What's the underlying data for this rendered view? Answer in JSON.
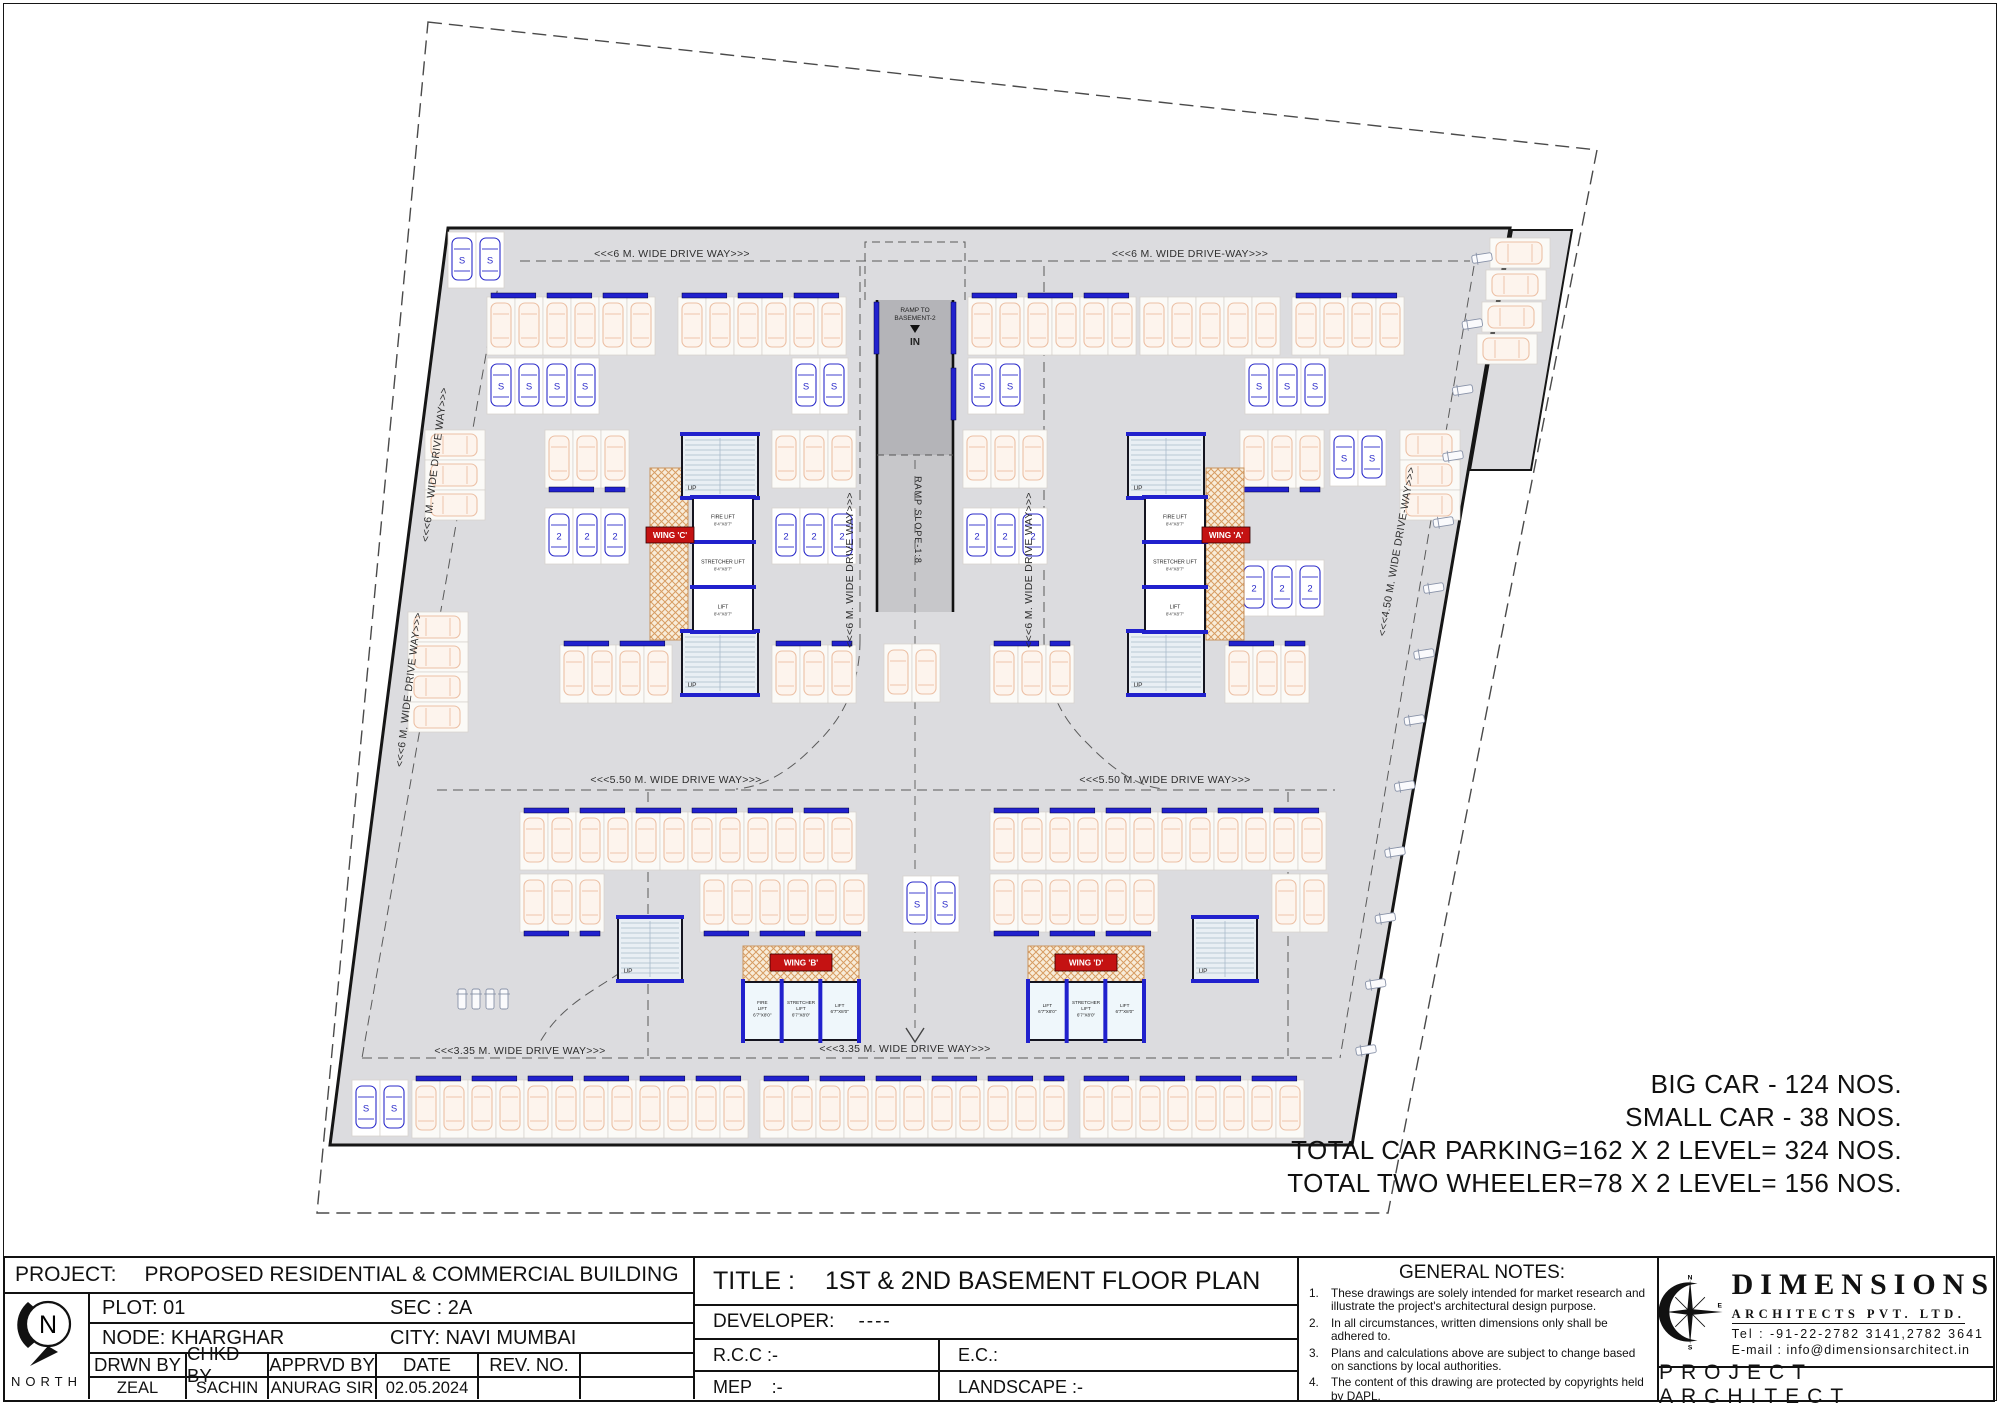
{
  "colors": {
    "blue": "#2121cd",
    "red": "#c41212",
    "hatch": "#d79c63",
    "plan_gray": "#dcdcdf",
    "big_car": "#ecc0a5",
    "small_car": "#2b2bca"
  },
  "stats": {
    "lines": [
      "BIG CAR - 124 NOS.",
      "SMALL CAR - 38 NOS.",
      "TOTAL CAR PARKING=162 X 2 LEVEL= 324 NOS.",
      "TOTAL TWO WHEELER=78 X 2 LEVEL= 156 NOS."
    ]
  },
  "titleblock": {
    "project_label": "PROJECT:",
    "project_value": "PROPOSED RESIDENTIAL & COMMERCIAL BUILDING",
    "plot": "PLOT: 01",
    "sec": "SEC : 2A",
    "node": "NODE: KHARGHAR",
    "city": "CITY: NAVI MUMBAI",
    "col_headers": [
      "DRWN BY",
      "CHKD BY",
      "APPRVD BY",
      "DATE",
      "REV. NO."
    ],
    "col_values": [
      "ZEAL",
      "SACHIN",
      "ANURAG SIR",
      "02.05.2024",
      ""
    ],
    "north_label": "NORTH",
    "north_letter": "N",
    "title_label": "TITLE :",
    "title_value": "1ST & 2ND BASEMENT FLOOR PLAN",
    "developer_label": "DEVELOPER:",
    "developer_value": "----",
    "rcc": "R.C.C :-",
    "ec": "E.C.:",
    "mep": "MEP    :-",
    "landscape": "LANDSCAPE :-"
  },
  "notes": {
    "heading": "GENERAL NOTES:",
    "items": [
      {
        "n": "1.",
        "text": "These drawings are solely intended for market research and illustrate the project's architectural design purpose."
      },
      {
        "n": "2.",
        "text": "In all circumstances, written dimensions only shall be adhered to."
      },
      {
        "n": "3.",
        "text": "Plans and calculations above are subject to change based on sanctions by local authorities."
      },
      {
        "n": "4.",
        "text": "The content of this drawing are protected by copyrights held by DAPL."
      }
    ]
  },
  "firm": {
    "name": "DIMENSIONS",
    "subtitle": "ARCHITECTS PVT. LTD.",
    "tel": "Tel : -91-22-2782 3141,2782 3641",
    "email": "E-mail : info@dimensionsarchitect.in",
    "role": "PROJECT ARCHITECT",
    "compass": {
      "n": "N",
      "e": "E",
      "s": "S"
    }
  },
  "plan": {
    "plot_boundary": [
      [
        428,
        22
      ],
      [
        1597,
        150
      ],
      [
        1388,
        1213
      ],
      [
        317,
        1213
      ]
    ],
    "building_outline": [
      [
        448,
        228
      ],
      [
        1510,
        228
      ],
      [
        1352,
        1145
      ],
      [
        330,
        1145
      ]
    ],
    "annex": [
      [
        1512,
        230
      ],
      [
        1572,
        230
      ],
      [
        1531,
        470
      ],
      [
        1470,
        470
      ]
    ],
    "aisle_paths": [
      "M520,261 H1470",
      "M500,275 L362,1058",
      "M362,1058 H1335",
      "M437,790 H1335",
      "M1474,266 L1340,1058",
      "M860,266 V640",
      "M1044,266 V640",
      "M860,640 Q860,702 816,744 Q776,786 736,789",
      "M1044,640 Q1044,702 1088,744 Q1128,786 1164,789",
      "M648,792 V1056",
      "M1288,792 V1056",
      "M645,952 C612,986 568,994 540,1042"
    ],
    "ramp": {
      "x": 877,
      "y": 300,
      "w": 76,
      "split": 455,
      "end": 612,
      "label1": "RAMP TO",
      "label2": "BASEMENT-2",
      "in_label": "IN",
      "slope": "RAMP SLOPE-1:8"
    },
    "driveways": [
      {
        "t": "<<<6 M. WIDE DRIVE WAY>>>",
        "x": 672,
        "y": 257,
        "r": 0
      },
      {
        "t": "<<<6 M. WIDE DRIVE-WAY>>>",
        "x": 1190,
        "y": 257,
        "r": 0
      },
      {
        "t": "<<<6 M. WIDE DRIVE WAY>>>",
        "x": 438,
        "y": 465,
        "r": -83
      },
      {
        "t": "<<<6 M. WIDE DRIVE WAY>>>",
        "x": 412,
        "y": 690,
        "r": -83
      },
      {
        "t": "<<<5.50 M. WIDE DRIVE WAY>>>",
        "x": 676,
        "y": 783,
        "r": 0
      },
      {
        "t": "<<<5.50 M. WIDE DRIVE WAY>>>",
        "x": 1165,
        "y": 783,
        "r": 0
      },
      {
        "t": "<<<3.35 M. WIDE DRIVE WAY>>>",
        "x": 520,
        "y": 1054,
        "r": 0
      },
      {
        "t": "<<<3.35 M. WIDE DRIVE WAY>>>",
        "x": 905,
        "y": 1052,
        "r": 0
      },
      {
        "t": "<<<4.50 M. WIDE DRIVE-WAY>>>",
        "x": 1400,
        "y": 552,
        "r": -80
      },
      {
        "t": "<<<6 M. WIDE DRIVE WAY>>>",
        "x": 853,
        "y": 570,
        "r": -90
      },
      {
        "t": "<<<6 M. WIDE DRIVE WAY>>>",
        "x": 1032,
        "y": 570,
        "r": -90
      }
    ],
    "lift_names": {
      "fire": "FIRE LIFT",
      "stretcher": "STRETCHER LIFT",
      "lift": "LIFT"
    },
    "lift_sizes": {
      "top": "8'4\"X8'7\"",
      "bottom": "6'7\"X8'0\""
    },
    "up_label": "UP",
    "small_car_label": "S",
    "stack_car_label": "2",
    "cores": [
      {
        "id": "core-top-left",
        "stairs": [
          [
            682,
            435,
            76,
            62
          ],
          [
            682,
            632,
            76,
            62
          ]
        ],
        "lifts": [
          693,
          497,
          60,
          135
        ],
        "dir": "v",
        "order": [
          "fire",
          "stretcher",
          "lift"
        ],
        "size": "top",
        "hatch": [
          650,
          468,
          38,
          172
        ],
        "wing": "WING 'C'",
        "wingbox": [
          646,
          527,
          48,
          16
        ]
      },
      {
        "id": "core-top-right",
        "stairs": [
          [
            1128,
            435,
            76,
            62
          ],
          [
            1128,
            632,
            76,
            62
          ]
        ],
        "lifts": [
          1145,
          497,
          60,
          135
        ],
        "dir": "v",
        "order": [
          "fire",
          "stretcher",
          "lift"
        ],
        "size": "top",
        "hatch": [
          1206,
          468,
          38,
          172
        ],
        "wing": "WING 'A'",
        "wingbox": [
          1202,
          527,
          48,
          16
        ]
      },
      {
        "id": "core-bottom-left",
        "stairs": [
          [
            618,
            918,
            64,
            62
          ]
        ],
        "lifts": [
          743,
          982,
          116,
          58
        ],
        "dir": "h",
        "order": [
          "fire",
          "stretcher",
          "lift"
        ],
        "size": "bottom",
        "hatch": [
          743,
          946,
          116,
          36
        ],
        "wing": "WING 'B'",
        "wingbox": [
          770,
          954,
          62,
          17
        ]
      },
      {
        "id": "core-bottom-right",
        "stairs": [
          [
            1193,
            918,
            64,
            62
          ]
        ],
        "lifts": [
          1028,
          982,
          116,
          58
        ],
        "dir": "h",
        "order": [
          "lift",
          "stretcher",
          "lift"
        ],
        "size": "bottom",
        "hatch": [
          1028,
          946,
          116,
          36
        ],
        "wing": "WING 'D'",
        "wingbox": [
          1055,
          954,
          62,
          17
        ]
      }
    ],
    "strips": [
      {
        "x": 448,
        "y": 232,
        "n": 2,
        "t": "small",
        "d": "v"
      },
      {
        "x": 487,
        "y": 297,
        "n": 6,
        "t": "big",
        "d": "v",
        "stop": "top"
      },
      {
        "x": 678,
        "y": 297,
        "n": 6,
        "t": "big",
        "d": "v",
        "stop": "top"
      },
      {
        "x": 968,
        "y": 297,
        "n": 6,
        "t": "big",
        "d": "v",
        "stop": "top"
      },
      {
        "x": 1140,
        "y": 297,
        "n": 5,
        "t": "big",
        "d": "v"
      },
      {
        "x": 1292,
        "y": 297,
        "n": 4,
        "t": "big",
        "d": "v",
        "stop": "top"
      },
      {
        "x": 487,
        "y": 358,
        "n": 4,
        "t": "small",
        "d": "v"
      },
      {
        "x": 792,
        "y": 358,
        "n": 2,
        "t": "small",
        "d": "v"
      },
      {
        "x": 968,
        "y": 358,
        "n": 2,
        "t": "small",
        "d": "v"
      },
      {
        "x": 1245,
        "y": 358,
        "n": 3,
        "t": "small",
        "d": "v"
      },
      {
        "x": 1490,
        "y": 238,
        "n": 1,
        "t": "big",
        "d": "h"
      },
      {
        "x": 1486,
        "y": 270,
        "n": 1,
        "t": "big",
        "d": "h"
      },
      {
        "x": 1482,
        "y": 302,
        "n": 1,
        "t": "big",
        "d": "h"
      },
      {
        "x": 1477,
        "y": 334,
        "n": 1,
        "t": "big",
        "d": "h"
      },
      {
        "x": 1400,
        "y": 430,
        "n": 3,
        "t": "big",
        "d": "h"
      },
      {
        "x": 425,
        "y": 430,
        "n": 3,
        "t": "big",
        "d": "h"
      },
      {
        "x": 408,
        "y": 612,
        "n": 4,
        "t": "big",
        "d": "h"
      },
      {
        "x": 545,
        "y": 430,
        "n": 3,
        "t": "big",
        "d": "v",
        "stop": "bottom"
      },
      {
        "x": 545,
        "y": 508,
        "n": 3,
        "t": "stack",
        "d": "v"
      },
      {
        "x": 772,
        "y": 430,
        "n": 3,
        "t": "big",
        "d": "v"
      },
      {
        "x": 772,
        "y": 508,
        "n": 3,
        "t": "stack",
        "d": "v"
      },
      {
        "x": 963,
        "y": 430,
        "n": 3,
        "t": "big",
        "d": "v"
      },
      {
        "x": 963,
        "y": 508,
        "n": 3,
        "t": "stack",
        "d": "v"
      },
      {
        "x": 1240,
        "y": 430,
        "n": 3,
        "t": "big",
        "d": "v",
        "stop": "bottom"
      },
      {
        "x": 1240,
        "y": 560,
        "n": 3,
        "t": "stack",
        "d": "v"
      },
      {
        "x": 1330,
        "y": 430,
        "n": 2,
        "t": "small",
        "d": "v"
      },
      {
        "x": 560,
        "y": 645,
        "n": 4,
        "t": "big",
        "d": "v",
        "stop": "top"
      },
      {
        "x": 772,
        "y": 645,
        "n": 3,
        "t": "big",
        "d": "v",
        "stop": "top"
      },
      {
        "x": 884,
        "y": 644,
        "n": 2,
        "t": "big",
        "d": "v"
      },
      {
        "x": 990,
        "y": 645,
        "n": 3,
        "t": "big",
        "d": "v",
        "stop": "top"
      },
      {
        "x": 1225,
        "y": 645,
        "n": 3,
        "t": "big",
        "d": "v",
        "stop": "top"
      },
      {
        "x": 520,
        "y": 812,
        "n": 12,
        "t": "big",
        "d": "v",
        "stop": "top"
      },
      {
        "x": 520,
        "y": 874,
        "n": 3,
        "t": "big",
        "d": "v",
        "stop": "bottom"
      },
      {
        "x": 700,
        "y": 874,
        "n": 6,
        "t": "big",
        "d": "v",
        "stop": "bottom"
      },
      {
        "x": 903,
        "y": 876,
        "n": 2,
        "t": "small",
        "d": "v"
      },
      {
        "x": 990,
        "y": 812,
        "n": 12,
        "t": "big",
        "d": "v",
        "stop": "top"
      },
      {
        "x": 990,
        "y": 874,
        "n": 6,
        "t": "big",
        "d": "v",
        "stop": "bottom"
      },
      {
        "x": 1272,
        "y": 874,
        "n": 2,
        "t": "big",
        "d": "v"
      },
      {
        "x": 455,
        "y": 986,
        "n": 4,
        "t": "bike",
        "d": "v"
      },
      {
        "x": 352,
        "y": 1080,
        "n": 2,
        "t": "small",
        "d": "v"
      },
      {
        "x": 412,
        "y": 1080,
        "n": 12,
        "t": "big",
        "d": "v",
        "stop": "top"
      },
      {
        "x": 760,
        "y": 1080,
        "n": 11,
        "t": "big",
        "d": "v",
        "stop": "top"
      },
      {
        "x": 1080,
        "y": 1080,
        "n": 8,
        "t": "big",
        "d": "v",
        "stop": "top"
      }
    ],
    "bikelines": [
      {
        "x1": 1482,
        "y1": 258,
        "x2": 1366,
        "y2": 1050,
        "n": 13,
        "ang": -99
      }
    ]
  }
}
